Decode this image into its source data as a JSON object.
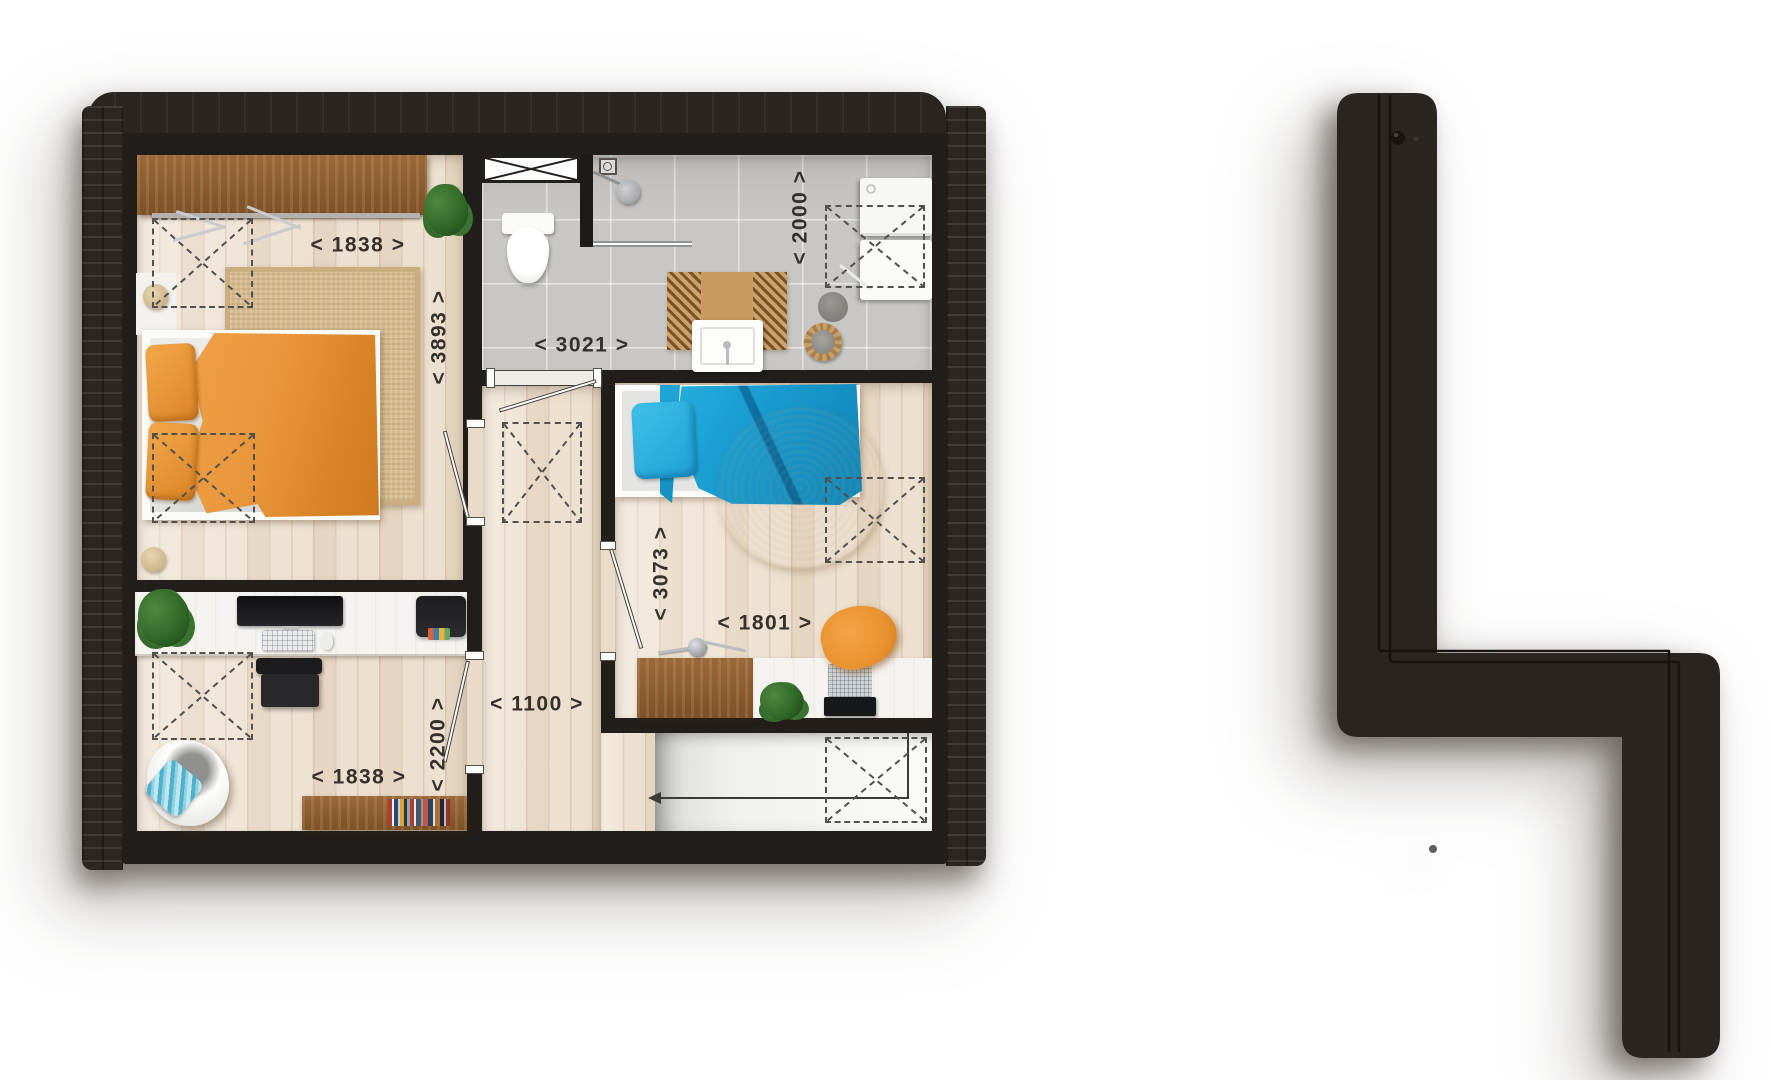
{
  "floorplan": {
    "type": "residential-upper-floor-plan",
    "dimension_labels": [
      {
        "id": "bedroom1-width",
        "text": "< 1838 >",
        "orientation": "horizontal"
      },
      {
        "id": "bedroom1-depth",
        "text": "< 3893 >",
        "orientation": "vertical"
      },
      {
        "id": "bathroom-width",
        "text": "< 3021 >",
        "orientation": "horizontal"
      },
      {
        "id": "bathroom-depth",
        "text": "< 2000 >",
        "orientation": "vertical"
      },
      {
        "id": "bedroom2-depth",
        "text": "< 3073 >",
        "orientation": "vertical"
      },
      {
        "id": "bedroom2-width",
        "text": "< 1801 >",
        "orientation": "horizontal"
      },
      {
        "id": "hallway-width",
        "text": "< 1100 >",
        "orientation": "horizontal"
      },
      {
        "id": "bedroom3-depth",
        "text": "< 2200 >",
        "orientation": "vertical"
      },
      {
        "id": "bedroom3-width",
        "text": "< 1838 >",
        "orientation": "horizontal"
      }
    ],
    "colors": {
      "wall": "#221e1b",
      "roof": "#2a2521",
      "wood_floor": "#ebdcc9",
      "bathroom_floor": "#c8c7c5",
      "landing_floor": "#fbfbfa",
      "accent_orange": "#e8953a",
      "accent_blue": "#1795c9",
      "rug_beige": "#d5ba8e",
      "label_text": "#35302c"
    },
    "rooms": [
      {
        "id": "bedroom-1",
        "furniture": [
          "wardrobe",
          "clothes-rail",
          "hangers",
          "double-bed",
          "orange-duvet",
          "orange-pillows",
          "area-rug",
          "pouf",
          "plant"
        ]
      },
      {
        "id": "bathroom",
        "furniture": [
          "toilet",
          "shower-head",
          "shower-partition",
          "glass-screen",
          "floor-drain",
          "sink",
          "bath-mat",
          "laundry-basket",
          "washing-machine",
          "cabinet",
          "towel"
        ]
      },
      {
        "id": "bedroom-2",
        "furniture": [
          "single-bed",
          "blue-duvet",
          "blue-pillow",
          "shag-rug",
          "dresser-desk",
          "desk",
          "desk-lamp",
          "laptop",
          "plant",
          "orange-chair"
        ]
      },
      {
        "id": "bedroom-3",
        "furniture": [
          "desk",
          "monitor",
          "keyboard",
          "mouse",
          "printer",
          "desk-chair",
          "lounge-chair",
          "striped-pillow",
          "bookshelf",
          "plant"
        ]
      },
      {
        "id": "hallway",
        "furniture": []
      },
      {
        "id": "stair-landing",
        "furniture": [
          "stair-direction-arrow"
        ]
      }
    ],
    "roof_window_marker_count": 7
  }
}
